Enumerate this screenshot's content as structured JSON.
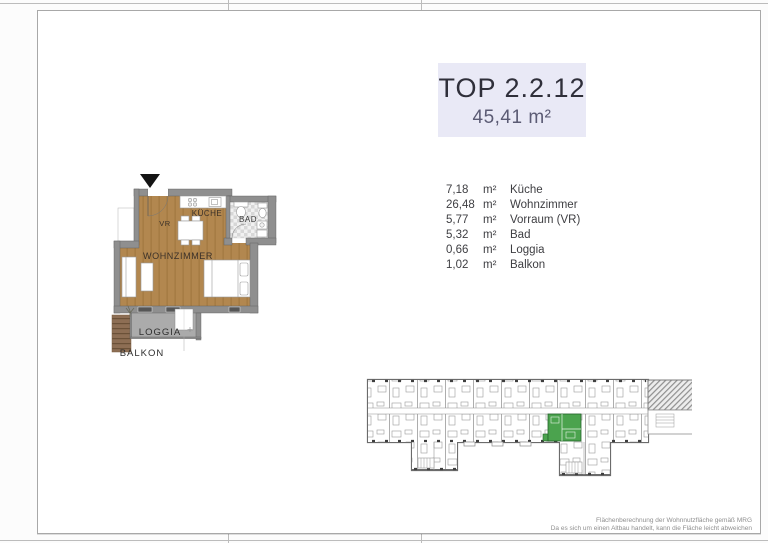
{
  "title_box": {
    "title": "TOP 2.2.12",
    "area": "45,41 m²"
  },
  "rooms": [
    {
      "area": "7,18",
      "unit": "m²",
      "name": "Küche"
    },
    {
      "area": "26,48",
      "unit": "m²",
      "name": "Wohnzimmer"
    },
    {
      "area": "5,77",
      "unit": "m²",
      "name": "Vorraum (VR)"
    },
    {
      "area": "5,32",
      "unit": "m²",
      "name": "Bad"
    },
    {
      "area": "0,66",
      "unit": "m²",
      "name": "Loggia"
    },
    {
      "area": "1,02",
      "unit": "m²",
      "name": "Balkon"
    }
  ],
  "floorplan_labels": {
    "vorraum": "VR",
    "kueche": "KÜCHE",
    "bad": "BAD",
    "wohnzimmer": "WOHNZIMMER",
    "loggia": "LOGGIA",
    "balkon": "BALKON"
  },
  "footer": {
    "line1": "Flächenberechnung der Wohnnutzfläche gemäß MRG",
    "line2": "Da es sich um einen Altbau handelt, kann die Fläche leicht abweichen"
  },
  "colors": {
    "highlight_green": "#4ba34e",
    "title_bg": "#e9e9f6",
    "wood_floor": "#b2874f",
    "wall_gray": "#8f8f8f"
  }
}
